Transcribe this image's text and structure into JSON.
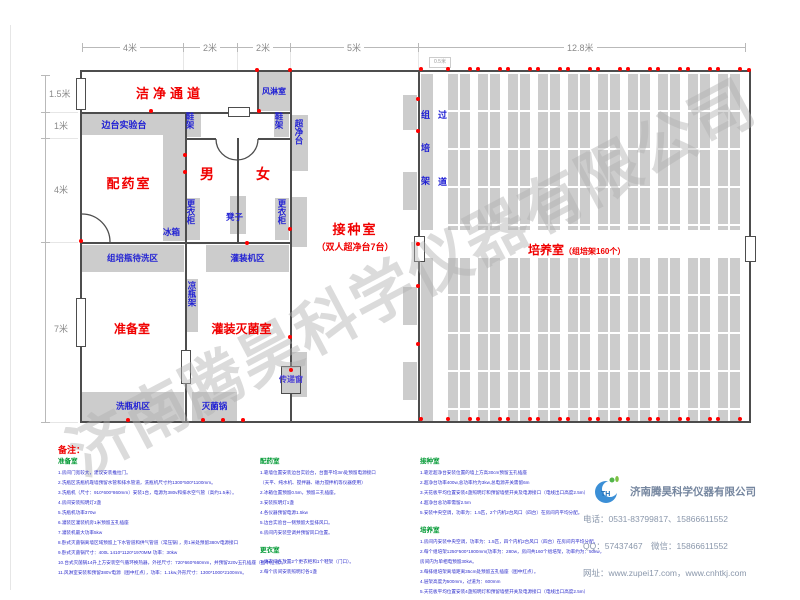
{
  "watermark": "济南腾昊科学仪器有限公司",
  "dims": {
    "top": [
      "4米",
      "2米",
      "2米",
      "5米",
      "12.8米"
    ],
    "left": [
      "1.5米",
      "1米",
      "4米",
      "7米"
    ],
    "rack_offset": "0.5米"
  },
  "labels": {
    "clean_corridor": "洁净通道",
    "air_shower": "风淋室",
    "side_bench": "边台实验台",
    "shoe_rack": "鞋架",
    "clean_bench": "超净台",
    "male": "男",
    "female": "女",
    "locker": "更衣柜",
    "stool": "凳子",
    "fridge": "冰箱",
    "pharmacy_room": "配药室",
    "bottle_wait_area": "组培瓶待洗区",
    "filling_area": "灌装机区",
    "cooling_rack": "凉瓶架",
    "prep_room": "准备室",
    "fill_steril_room": "灌装灭菌室",
    "bottle_washer_area": "洗瓶机区",
    "sterilizer": "灭菌锅",
    "transfer_window": "传递窗",
    "inoculation_room": "接种室",
    "inoculation_sub": "（双人超净台7台）",
    "culture_room": "培养室",
    "culture_sub": "（组培架160个）",
    "culture_rack": "组培架",
    "aisle": "过道"
  },
  "notes": {
    "title": "备注：",
    "columns": [
      [
        {
          "heading": "准备室",
          "lines": [
            "1.房间门宽较大，建议安装推拉门。",
            "2.洗瓶区洗瓶机靠墙预留水管和排水管道，洗瓶机尺寸约1300*500*1100mm。",
            "3.洗瓶机（尺寸：910*600*860mm）安装1台，电源为380v和排水空气管（高约1.5米）。",
            "4.房间安装照明灯2盏",
            "5.洗瓶机功率370w",
            "6.灌装区灌装机旁1米预留五孔插座",
            "7.灌装机最大功率5kw",
            "8.卧式灭菌锅离墙区域预留上下水管道和供气管道（常压锅），旁1米处预留380V电源接口",
            "9.卧式灭菌锅尺寸：400L 1410*1120*1970MM 功率：30kw",
            "10.台式灭菌锅14升上方安装空气循环换热器，外径尺寸：720*660*660mm，并预留220v五孔插座（图中红点）。",
            "11.风淋室安装和预留380V电源（图中红点），功率：1.1kw,外形尺寸：1300*1000*2100mm。"
          ]
        }
      ],
      [
        {
          "heading": "配药室",
          "lines": [
            "1.靠墙位置安装边台实验台，台面平均3m处预留电源接口",
            "（天平、纯水机、搅拌器、磁力搅拌机等仪器使用）",
            "2.冰箱位置预留0.5m，预留三孔插座。",
            "3.安装照明灯1盏",
            "4.各仪器预留电源1.5kw",
            "5.边台实验台一侧预留大型排风口。",
            "6.房间内安装空调并预留风口位置。"
          ]
        },
        {
          "heading": "更衣室",
          "lines": [
            "1.更衣间各放置2个更衣柜和1个鞋架（门口）。",
            "2.每个房间安装照明灯各1盏"
          ]
        }
      ],
      [
        {
          "heading": "接种室",
          "lines": [
            "1.靠近超净台安装位置的墙上方高30cm预留五孔插座",
            "2.超净台功率400w,总功率约为3kw,总电源开关需留6m",
            "3.天花板平均位置安装4盏照明灯和预留墙壁开关及电源接口（电线出口高度2.5m）",
            "4.超净台总功率需留2.5m",
            "5.安装中央空调，功率为：1.5匹，2个内机2台风口（四台）在房间内平均分配。"
          ]
        },
        {
          "heading": "培养室",
          "lines": [
            "1.房间内安装中央空调，功率为：1.5匹，四个内机2台风口（四台）在房间内平均分配。",
            "2.每个组培架1250*500*1800mm(功率为：280w，房间共160个组培架，功率约为：50kw，",
            "房间内为单相电预留30kw。",
            "3.每排组培架离墙距离35cm处预留五孔插座（图中红点）。",
            "4.层架高度为500mm，过道为：600mm",
            "5.天花板平均位置安装4盏照明灯和预留墙壁开关及电源接口（电线出口高度2.5m）"
          ]
        }
      ]
    ]
  },
  "company": {
    "name": "济南腾昊科学仪器有限公司",
    "phone": "电话：0531-83799817、15866611552",
    "qq_wechat": "QQ：57437467　微信：15866611552",
    "website": "网址：www.zupei17.com，www.cnhtkj.com",
    "logo_text": "TH"
  }
}
